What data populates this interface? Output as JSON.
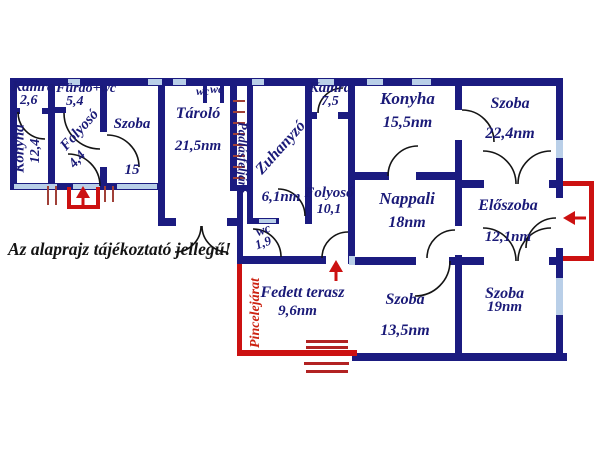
{
  "title": "Hungarian apartment floor plan",
  "disclaimer": "Az alaprajz tájékoztató jellegű!",
  "rooms": {
    "kamra1": {
      "name": "Kamra",
      "area": "2,6"
    },
    "furdo": {
      "name": "Fürdő+wc",
      "area": "5,4"
    },
    "konyha1": {
      "name": "Konyha",
      "area": "12,4"
    },
    "folyoso1": {
      "name": "Folyosó",
      "area": "4,4"
    },
    "szoba15": {
      "name": "Szoba",
      "area": "15"
    },
    "tarolo": {
      "name": "Tároló",
      "area": "21,5nm"
    },
    "wc_top1": {
      "name": "wc"
    },
    "wc_top2": {
      "name": "wc"
    },
    "padlasfeljaro": {
      "name": "Padlásfeljáró"
    },
    "zuhanyzo": {
      "name": "Zuhanyzó",
      "area": "6,1nm"
    },
    "kamra2": {
      "name": "Kamra",
      "area": "7,5"
    },
    "konyha2": {
      "name": "Konyha",
      "area": "15,5nm"
    },
    "szoba224": {
      "name": "Szoba",
      "area": "22,4nm"
    },
    "folyoso2": {
      "name": "Folyosó",
      "area": "10,1"
    },
    "nappali": {
      "name": "Nappali",
      "area": "18nm"
    },
    "eloszoba": {
      "name": "Előszoba",
      "area": "12,1nm"
    },
    "wc19": {
      "name": "wc",
      "area": "1,9"
    },
    "terasz": {
      "name": "Fedett terasz",
      "area": "9,6nm"
    },
    "szoba135": {
      "name": "Szoba",
      "area": "13,5nm"
    },
    "szoba19": {
      "name": "Szoba",
      "area": "19nm"
    },
    "pincelejarat": {
      "name": "Pincelejárat"
    }
  },
  "colors": {
    "wall": "#1b1b80",
    "window": "#b9cfe8",
    "accent_red": "#cc1111",
    "stair_red": "#b22222",
    "label_navy": "#1a1a78",
    "disclaimer_black": "#141414",
    "background": "#ffffff"
  }
}
